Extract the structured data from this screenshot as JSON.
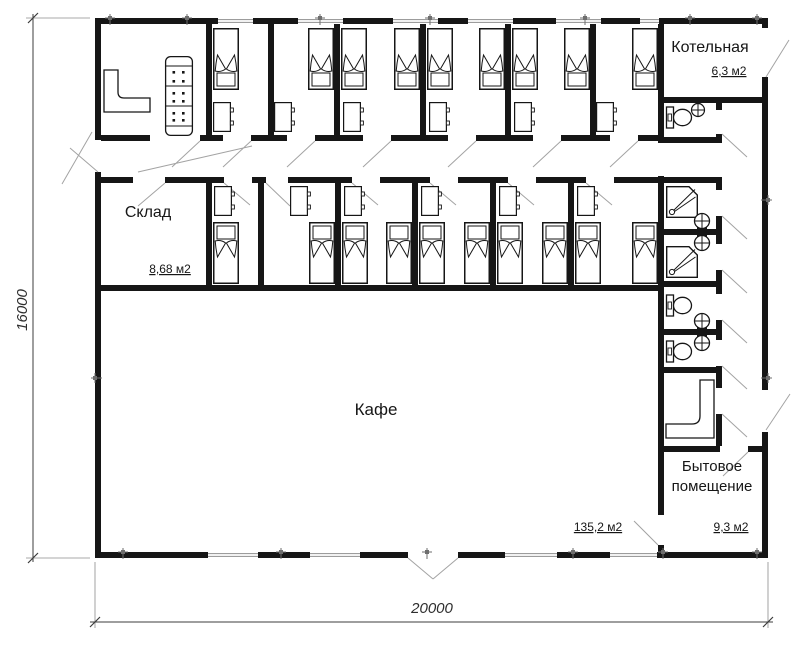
{
  "rooms": {
    "boiler": {
      "label": "Котельная",
      "area": "6,3 м2"
    },
    "storage": {
      "label": "Склад",
      "area": "8,68 м2"
    },
    "cafe": {
      "label": "Кафе",
      "area": "135,2 м2"
    },
    "utility": {
      "label_line1": "Бытовое",
      "label_line2": "помещение",
      "area": "9,3 м2"
    }
  },
  "dimensions": {
    "height_total": "16000",
    "width_total": "20000"
  }
}
